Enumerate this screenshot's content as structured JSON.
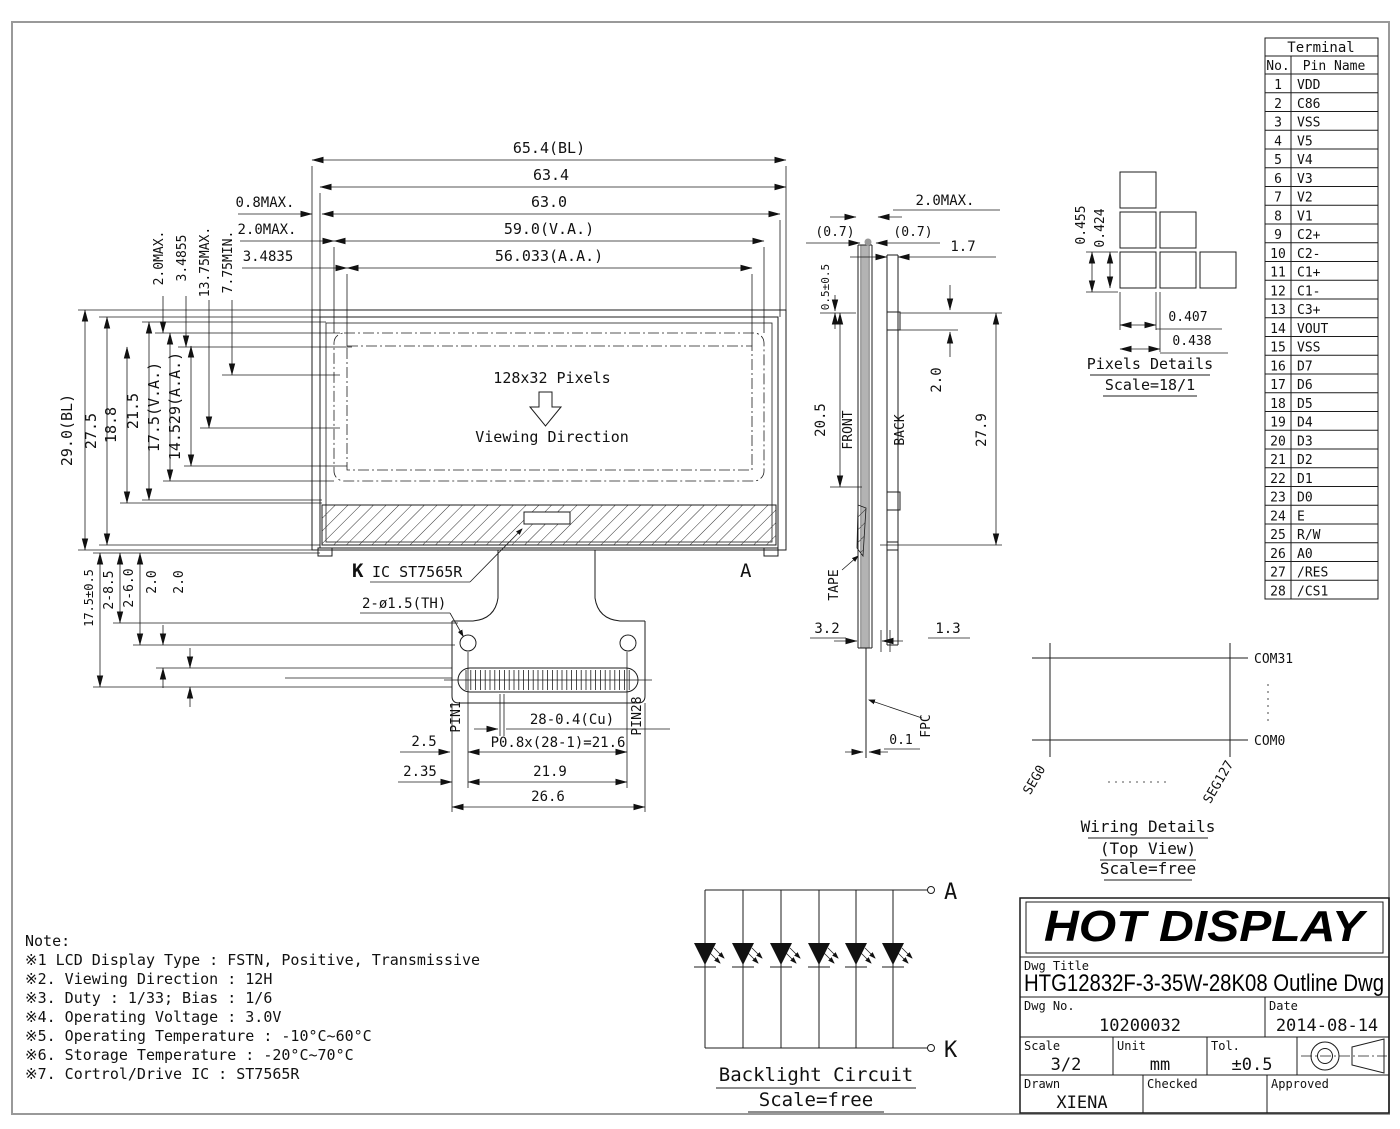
{
  "front_view": {
    "top_dims": [
      "65.4(BL)",
      "63.4",
      "63.0",
      "59.0(V.A.)",
      "56.033(A.A.)"
    ],
    "top_offsets": [
      "0.8MAX.",
      "2.0MAX.",
      "3.4835"
    ],
    "left_rotated_dims": [
      "2.0MAX.",
      "3.4855",
      "13.75MAX.",
      "7.75MIN."
    ],
    "left_dims": [
      "29.0(BL)",
      "27.5",
      "18.8",
      "21.5",
      "17.5(V.A.)",
      "14.529(A.A.)"
    ],
    "display_label": "128x32 Pixels",
    "viewing_direction_label": "Viewing Direction",
    "cathode_label": "K",
    "ic_label": "IC ST7565R",
    "anode_label": "A",
    "hole_label": "2-ø1.5(TH)",
    "fold_dims": [
      "17.5±0.5",
      "2-8.5",
      "2-6.0",
      "2.0",
      "2.0"
    ],
    "pin1_label": "PIN1",
    "pin28_label": "PIN28",
    "copper_label": "28-0.4(Cu)",
    "pitch_label": "P0.8x(28-1)=21.6",
    "bottom_dims": [
      "2.5",
      "2.35",
      "21.9",
      "26.6"
    ]
  },
  "side_view": {
    "front_label": "FRONT",
    "back_label": "BACK",
    "tape_label": "TAPE",
    "fpc_label": "FPC",
    "dims": {
      "thickness": "2.0MAX.",
      "glass_left": "(0.7)",
      "glass_right": "(0.7)",
      "back_gap": "1.7",
      "offset": "0.5±0.5",
      "front_height": "20.5",
      "tab": "2.0",
      "back_height": "27.9",
      "bottom_left": "3.2",
      "bottom_right": "1.3",
      "fpc_thickness": "0.1"
    }
  },
  "pixels_details": {
    "dims": [
      "0.455",
      "0.424",
      "0.407",
      "0.438"
    ],
    "title": "Pixels Details",
    "scale": "Scale=18/1"
  },
  "terminal_table": {
    "title": "Terminal",
    "col_no": "No.",
    "col_pin": "Pin Name",
    "rows": [
      [
        "1",
        "VDD"
      ],
      [
        "2",
        "C86"
      ],
      [
        "3",
        "VSS"
      ],
      [
        "4",
        "V5"
      ],
      [
        "5",
        "V4"
      ],
      [
        "6",
        "V3"
      ],
      [
        "7",
        "V2"
      ],
      [
        "8",
        "V1"
      ],
      [
        "9",
        "C2+"
      ],
      [
        "10",
        "C2-"
      ],
      [
        "11",
        "C1+"
      ],
      [
        "12",
        "C1-"
      ],
      [
        "13",
        "C3+"
      ],
      [
        "14",
        "VOUT"
      ],
      [
        "15",
        "VSS"
      ],
      [
        "16",
        "D7"
      ],
      [
        "17",
        "D6"
      ],
      [
        "18",
        "D5"
      ],
      [
        "19",
        "D4"
      ],
      [
        "20",
        "D3"
      ],
      [
        "21",
        "D2"
      ],
      [
        "22",
        "D1"
      ],
      [
        "23",
        "D0"
      ],
      [
        "24",
        "E"
      ],
      [
        "25",
        "R/W"
      ],
      [
        "26",
        "A0"
      ],
      [
        "27",
        "/RES"
      ],
      [
        "28",
        "/CS1"
      ]
    ]
  },
  "wiring_details": {
    "com_top": "COM31",
    "com_bottom": "COM0",
    "seg_left": "SEG0",
    "seg_right": "SEG127",
    "title": "Wiring Details",
    "subtitle": "(Top View)",
    "scale": "Scale=free"
  },
  "backlight": {
    "anode": "A",
    "cathode": "K",
    "title": "Backlight Circuit",
    "scale": "Scale=free"
  },
  "notes": {
    "heading": "Note:",
    "items": [
      "※1 LCD Display Type : FSTN, Positive, Transmissive",
      "※2. Viewing Direction : 12H",
      "※3. Duty : 1/33; Bias : 1/6",
      "※4. Operating Voltage : 3.0V",
      "※5. Operating Temperature : -10°C~60°C",
      "※6. Storage Temperature : -20°C~70°C",
      "※7. Cortrol/Drive IC : ST7565R"
    ]
  },
  "title_block": {
    "company": "HOT DISPLAY",
    "dwg_title_label": "Dwg Title",
    "dwg_title": "HTG12832F-3-35W-28K08 Outline Dwg",
    "dwg_no_label": "Dwg No.",
    "dwg_no": "10200032",
    "date_label": "Date",
    "date": "2014-08-14",
    "scale_label": "Scale",
    "scale": "3/2",
    "unit_label": "Unit",
    "unit": "mm",
    "tol_label": "Tol.",
    "tol": "±0.5",
    "drawn_label": "Drawn",
    "drawn": "XIENA",
    "checked_label": "Checked",
    "approved_label": "Approved"
  }
}
